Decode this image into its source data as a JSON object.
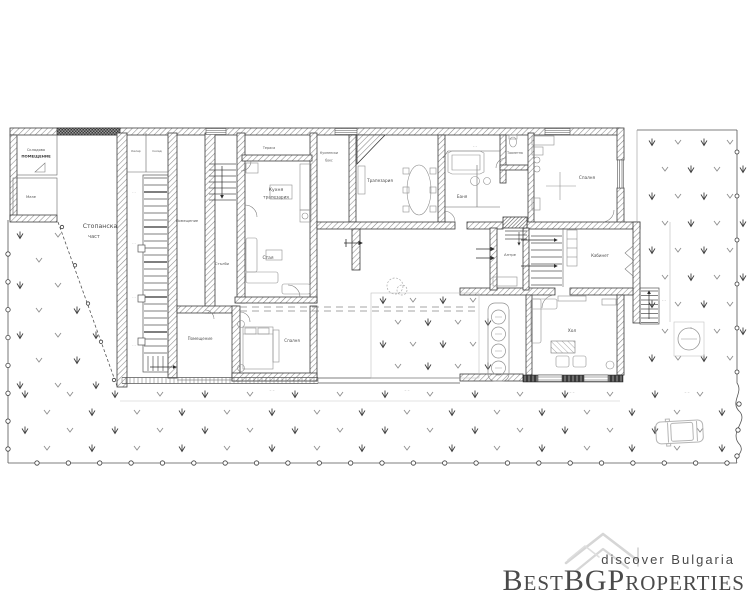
{
  "watermark": {
    "brand": "BestBGProperties",
    "tagline": "discover Bulgaria",
    "brand_color": "#dcdcdc",
    "tagline_color": "#d2d2d2",
    "logo_color": "#d6d6d6"
  },
  "plan": {
    "rooms": {
      "storage1a": "Складово",
      "storage1b": "ПОМЕЩЕНИЕ",
      "storage2": "Мазе",
      "farm1": "Стопанска",
      "farm2": "част",
      "cell1": "Килер",
      "cell2": "Склад",
      "narrow": "Помещение",
      "stairhall": "Стълби",
      "kitchen1": "Кухня",
      "kitchen2": "трапезария",
      "room_mid": "Стая",
      "bedroom1": "Спалня",
      "room2": "Помещение",
      "terrace": "Тераса",
      "niche1": "Кухненски",
      "niche2": "бокс",
      "dining": "Трапезария",
      "bath": "Баня",
      "wc": "Тоалетна",
      "bedroom2": "Спалня",
      "cabinet": "Кабинет",
      "entry": "Антре",
      "living": "Хол"
    },
    "dim_mark": "– –"
  }
}
